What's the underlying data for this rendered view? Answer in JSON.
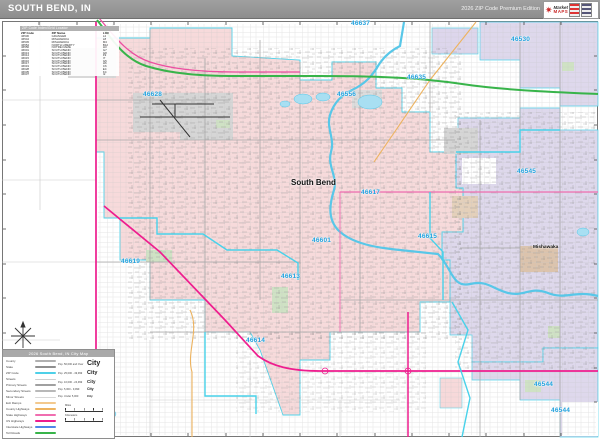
{
  "header": {
    "title": "SOUTH BEND, IN",
    "edition": "2026 ZIP Code Premium Edition",
    "logo": {
      "line1": "Market",
      "line2": "MAPS"
    }
  },
  "zip_index": {
    "title": "ZIP Code Index/Grid Locator",
    "columns": [
      "ZIP Code",
      "ZIP Name",
      "LOC"
    ],
    "rows": [
      {
        "zip": "46530",
        "name": "GRANGER",
        "loc": "L2"
      },
      {
        "zip": "46544",
        "name": "MISHAWAKA",
        "loc": "L8"
      },
      {
        "zip": "46545",
        "name": "MISHAWAKA",
        "loc": "M4"
      },
      {
        "zip": "46554",
        "name": "NORTH LIBERTY",
        "loc": "B12"
      },
      {
        "zip": "46556",
        "name": "NOTRE DAME",
        "loc": "H3"
      },
      {
        "zip": "46601",
        "name": "SOUTH BEND",
        "loc": "G7"
      },
      {
        "zip": "46613",
        "name": "SOUTH BEND",
        "loc": "G8"
      },
      {
        "zip": "46614",
        "name": "SOUTH BEND",
        "loc": "F9"
      },
      {
        "zip": "46615",
        "name": "SOUTH BEND",
        "loc": "I7"
      },
      {
        "zip": "46616",
        "name": "SOUTH BEND",
        "loc": "G5"
      },
      {
        "zip": "46617",
        "name": "SOUTH BEND",
        "loc": "H6"
      },
      {
        "zip": "46619",
        "name": "SOUTH BEND",
        "loc": "C6"
      },
      {
        "zip": "46628",
        "name": "SOUTH BEND",
        "loc": "E4"
      },
      {
        "zip": "46635",
        "name": "SOUTH BEND",
        "loc": "K4"
      },
      {
        "zip": "46637",
        "name": "SOUTH BEND",
        "loc": "I2"
      }
    ]
  },
  "map": {
    "city_labels": [
      "South Bend",
      "Mishawaka"
    ],
    "zip_labels": [
      "46637",
      "46530",
      "46635",
      "46628",
      "46556",
      "46545",
      "46617",
      "46619",
      "46601",
      "46615",
      "46613",
      "46614",
      "46544",
      "46544"
    ]
  },
  "legend": {
    "title": "2026 South Bend, IN City Map",
    "line_items": [
      {
        "label": "County",
        "color": "#b0b0b0"
      },
      {
        "label": "State",
        "color": "#8f8f8f"
      },
      {
        "label": "ZIP Code",
        "color": "#4ed0e8"
      },
      {
        "label": "Streets",
        "color": "#cfcfcf"
      },
      {
        "label": "Primary Streets",
        "color": "#a0a0a0"
      },
      {
        "label": "Secondary Streets",
        "color": "#b8b8b8"
      },
      {
        "label": "Minor Streets",
        "color": "#d8d8d8"
      },
      {
        "label": "Exit Ramps",
        "color": "#f3c98e"
      },
      {
        "label": "County Highways",
        "color": "#edb35f"
      },
      {
        "label": "State Highways",
        "color": "#f06eb0"
      },
      {
        "label": "US Highways",
        "color": "#ee1d8e"
      },
      {
        "label": "Interstate Highways",
        "color": "#4f86e8"
      },
      {
        "label": "Toll Roads",
        "color": "#38b44a"
      }
    ],
    "population_classes": [
      {
        "label": "Pop. 50,000 and Over",
        "sample": "City"
      },
      {
        "label": "Pop. 25,000 - 49,999",
        "sample": "City"
      },
      {
        "label": "Pop. 10,000 - 24,999",
        "sample": "City"
      },
      {
        "label": "Pop. 5,000 - 9,999",
        "sample": "City"
      },
      {
        "label": "Pop. Under 5,000",
        "sample": "City"
      }
    ],
    "scale": {
      "miles": "Miles",
      "kilometers": "Kilometers"
    }
  },
  "colors": {
    "header_bar": "#969696",
    "zip_label_text": "#1fa0dd",
    "south_bend_fill": "#f7d9da",
    "mishawaka_fill": "#ddd6ec",
    "water": "#58c7e8",
    "toll_road": "#38b44a",
    "us_highway": "#ee1d8e",
    "state_highway": "#f06eb0",
    "county_highway": "#edb35f",
    "zip_boundary": "#48d2ea",
    "park": "#cfe2c4",
    "airport": "#d6d6d6"
  }
}
